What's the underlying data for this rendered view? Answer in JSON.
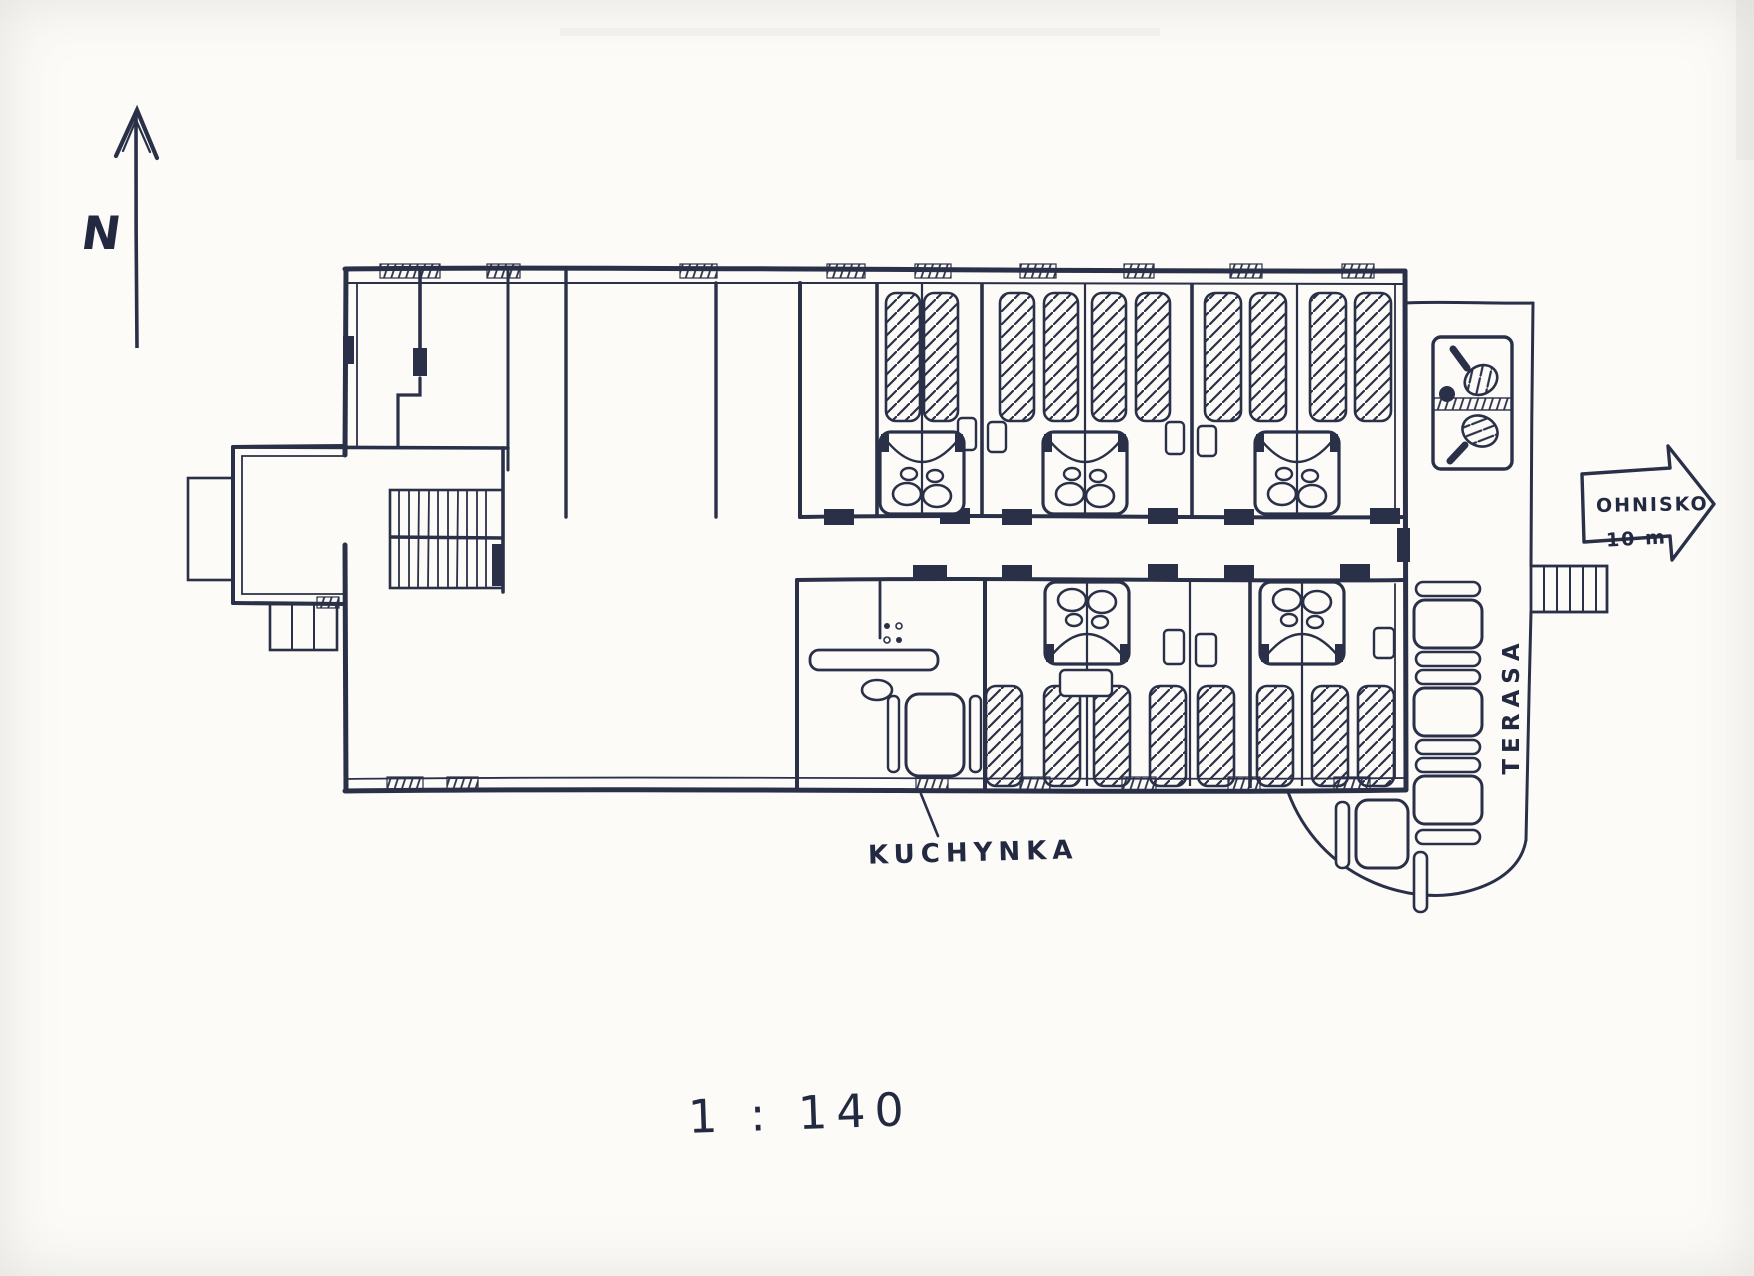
{
  "document": {
    "kind": "hand-drawn floor plan sketch (scanned)",
    "scale": "1 : 140"
  },
  "labels": {
    "north": "N",
    "kitchen": "KUCHYNKA",
    "terrace": "TERASA",
    "firepit": "OHNISKO",
    "firepit_distance": "10 m",
    "scale": "1 : 140"
  },
  "colors": {
    "ink": "#2a3047",
    "paper": "#fcfbf8"
  },
  "plan": {
    "features": [
      "north-arrow",
      "entrance-porch-with-exterior-steps",
      "interior-staircase",
      "large-hall",
      "central-corridor-with-door-openings",
      "bedrooms-with-hatched-beds-and-back-to-back-washbasins",
      "kitchen-with-stove-counter-sink-and-dining-table",
      "terrace-with-table-tennis-table-benches-and-tables",
      "terrace-steps-toward-fire-pit"
    ],
    "counts": {
      "beds_visible": 18,
      "washbasin_units": 5,
      "terrace_tables": 4,
      "terrace_benches": 9,
      "ping_pong_paddles": 2
    }
  }
}
